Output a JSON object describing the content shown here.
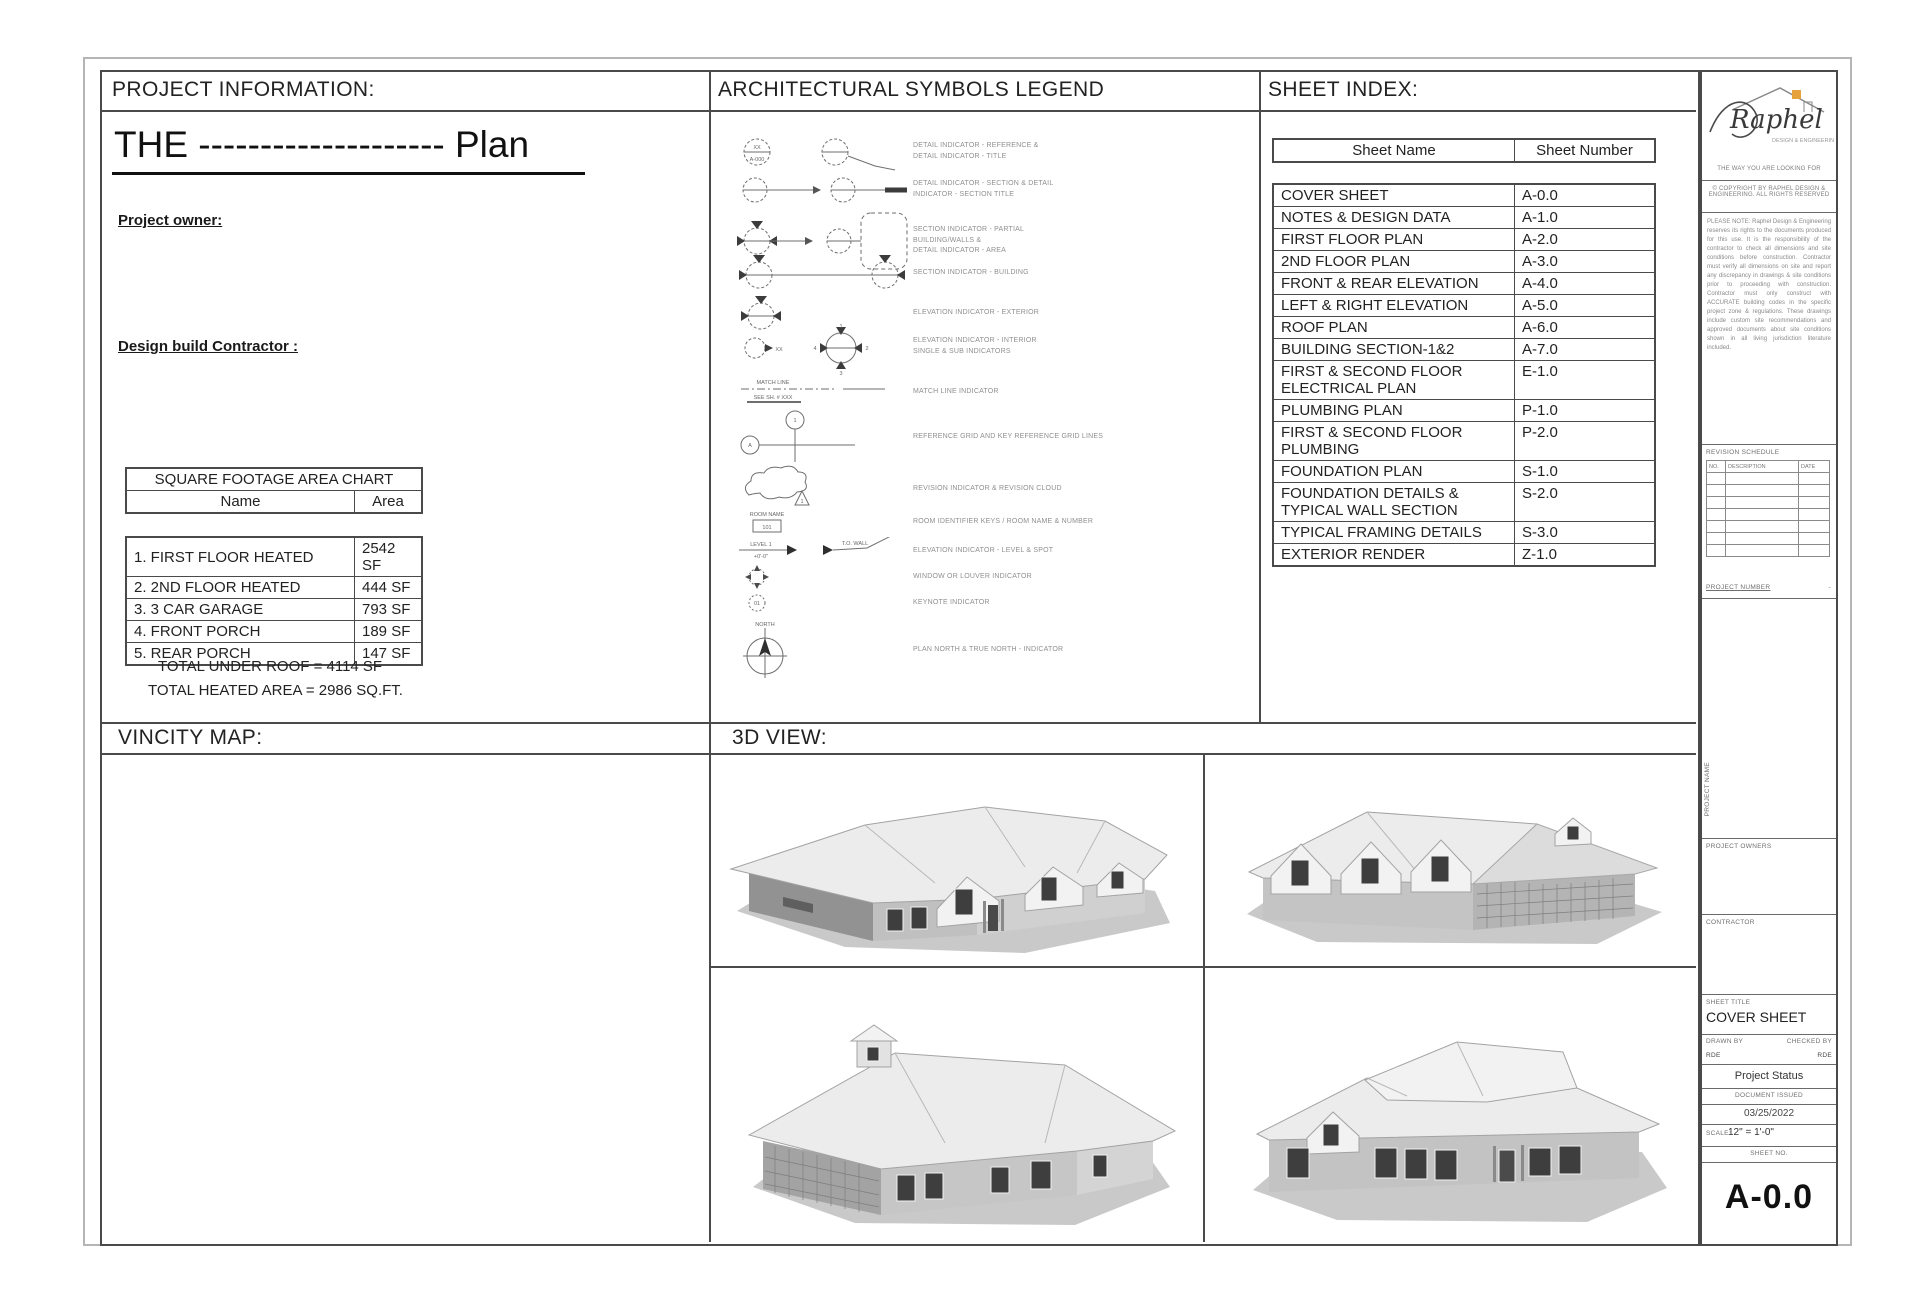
{
  "project_information": {
    "header": "PROJECT  INFORMATION:",
    "plan_title": "THE -------------------- Plan",
    "owner_label": "Project owner:",
    "contractor_label": "Design build Contractor :",
    "area_chart": {
      "title": "SQUARE FOOTAGE AREA CHART",
      "col_name": "Name",
      "col_area": "Area",
      "rows": [
        {
          "name": "1. FIRST FLOOR HEATED",
          "area": "2542 SF"
        },
        {
          "name": "2. 2ND FLOOR HEATED",
          "area": "444 SF"
        },
        {
          "name": "3. 3 CAR GARAGE",
          "area": "793 SF"
        },
        {
          "name": "4. FRONT PORCH",
          "area": "189 SF"
        },
        {
          "name": "5. REAR PORCH",
          "area": "147 SF"
        }
      ],
      "total_under_roof": "TOTAL UNDER ROOF = 4114 SF",
      "total_heated_area": "TOTAL HEATED AREA = 2986 SQ.FT."
    }
  },
  "symbols_legend": {
    "header": "ARCHITECTURAL SYMBOLS LEGEND",
    "items": [
      {
        "desc": "DETAIL INDICATOR - REFERENCE &\nDETAIL INDICATOR - TITLE"
      },
      {
        "desc": "DETAIL INDICATOR - SECTION & DETAIL\nINDICATOR - SECTION TITLE"
      },
      {
        "desc": "SECTION INDICATOR - PARTIAL\nBUILDING/WALLS &\nDETAIL INDICATOR - AREA"
      },
      {
        "desc": "SECTION INDICATOR - BUILDING"
      },
      {
        "desc": "ELEVATION INDICATOR - EXTERIOR"
      },
      {
        "desc": "ELEVATION INDICATOR - INTERIOR\nSINGLE & SUB INDICATORS"
      },
      {
        "desc": "MATCH LINE INDICATOR"
      },
      {
        "desc": "REFERENCE GRID AND KEY REFERENCE GRID LINES"
      },
      {
        "desc": "REVISION INDICATOR & REVISION CLOUD"
      },
      {
        "desc": "ROOM IDENTIFIER KEYS / ROOM NAME & NUMBER"
      },
      {
        "desc": "ELEVATION INDICATOR - LEVEL & SPOT"
      },
      {
        "desc": "WINDOW OR LOUVER INDICATOR"
      },
      {
        "desc": "KEYNOTE INDICATOR"
      },
      {
        "desc": "PLAN NORTH & TRUE NORTH - INDICATOR"
      }
    ],
    "labels": {
      "bubble_top": "XX",
      "bubble_bottom": "A-000",
      "grid_1": "1",
      "grid_a": "A",
      "room_name": "ROOM NAME",
      "room_no": "101",
      "match1": "MATCH LINE",
      "match2": "SEE SH. # XXX",
      "level1": "LEVEL 1",
      "level2": "+0'-0\"",
      "level_tag": "T.O. WALL",
      "north": "NORTH",
      "rev_no": "1",
      "keynote": "01"
    }
  },
  "sheet_index": {
    "header": "SHEET INDEX:",
    "col_name": "Sheet Name",
    "col_number": "Sheet Number",
    "rows": [
      {
        "name": "COVER SHEET",
        "number": "A-0.0"
      },
      {
        "name": "NOTES & DESIGN DATA",
        "number": "A-1.0"
      },
      {
        "name": "FIRST FLOOR PLAN",
        "number": "A-2.0"
      },
      {
        "name": "2ND FLOOR PLAN",
        "number": "A-3.0"
      },
      {
        "name": "FRONT & REAR ELEVATION",
        "number": "A-4.0"
      },
      {
        "name": "LEFT & RIGHT ELEVATION",
        "number": "A-5.0"
      },
      {
        "name": "ROOF PLAN",
        "number": "A-6.0"
      },
      {
        "name": "BUILDING SECTION-1&2",
        "number": "A-7.0"
      },
      {
        "name": "FIRST & SECOND FLOOR ELECTRICAL PLAN",
        "number": "E-1.0"
      },
      {
        "name": "PLUMBING PLAN",
        "number": "P-1.0"
      },
      {
        "name": "FIRST & SECOND FLOOR PLUMBING",
        "number": "P-2.0"
      },
      {
        "name": "FOUNDATION PLAN",
        "number": "S-1.0"
      },
      {
        "name": "FOUNDATION DETAILS & TYPICAL WALL SECTION",
        "number": "S-2.0"
      },
      {
        "name": "TYPICAL FRAMING DETAILS",
        "number": "S-3.0"
      },
      {
        "name": "EXTERIOR RENDER",
        "number": "Z-1.0"
      }
    ]
  },
  "vicinity_map": {
    "header": "VINCITY MAP:"
  },
  "view_3d": {
    "header": "3D VIEW:"
  },
  "title_block": {
    "logo_name": "Raphel",
    "logo_sub": "DESIGN & ENGINEERING",
    "tagline": "THE WAY YOU ARE LOOKING FOR",
    "copyright": "© COPYRIGHT BY RAPHEL DESIGN &\nENGINEERING. ALL RIGHTS RESERVED",
    "note": "PLEASE NOTE: Raphel Design & Engineering reserves its rights to the documents produced for this use. It is the responsibility of the contractor to check all dimensions and site conditions before construction. Contractor must verify all dimensions on site and report any discrepancy in drawings & site conditions prior to proceeding with construction. Contractor must only construct with ACCURATE building codes in the specific project zone & regulations. These drawings include custom site recommendations and approved documents about site conditions shown in all living jurisdiction literature included.",
    "revision_schedule": {
      "title": "REVISION SCHEDULE",
      "col_no": "NO.",
      "col_desc": "DESCRIPTION",
      "col_date": "DATE"
    },
    "project_number_label": "PROJECT NUMBER",
    "project_number_value": "-",
    "project_name_label": "PROJECT NAME",
    "project_owners_label": "PROJECT OWNERS",
    "contractor_label": "CONTRACTOR",
    "sheet_title_label": "SHEET TITLE",
    "sheet_title_value": "COVER SHEET",
    "drawn_by_label": "DRAWN BY",
    "drawn_by_value": "RDE",
    "checked_by_label": "CHECKED BY",
    "checked_by_value": "RDE",
    "project_status": "Project Status",
    "document_issued_label": "DOCUMENT ISSUED",
    "document_issued_date": "03/25/2022",
    "scale_label": "SCALE:",
    "scale_value": "12\" = 1'-0\"",
    "sheet_no_label": "SHEET NO.",
    "sheet_number": "A-0.0"
  }
}
